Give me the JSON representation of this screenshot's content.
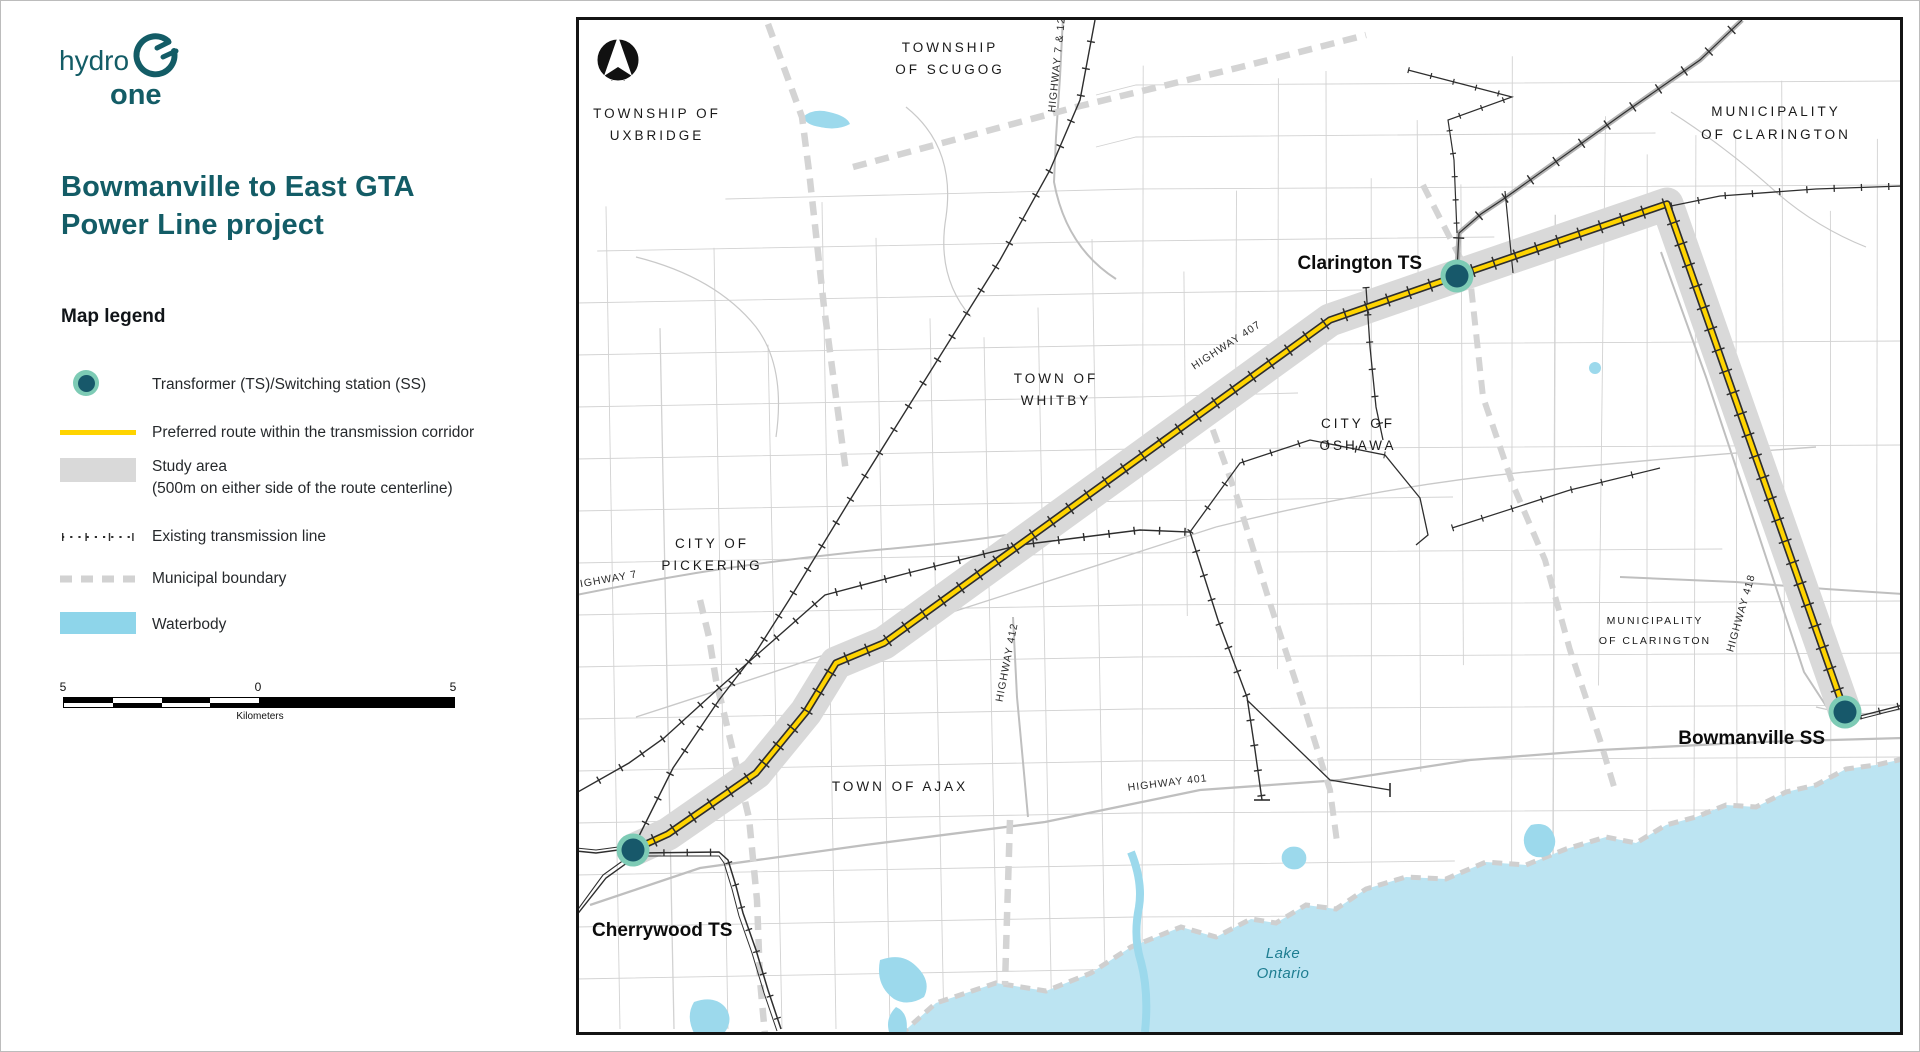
{
  "branding": {
    "logo_text_top": "hydro",
    "logo_text_bottom": "one"
  },
  "panel": {
    "title_line1": "Bowmanville to East GTA",
    "title_line2": "Power Line project",
    "legend_heading": "Map legend",
    "legend": {
      "station": "Transformer (TS)/Switching station (SS)",
      "route": "Preferred route within the transmission corridor",
      "study_area_line1": "Study area",
      "study_area_line2": "(500m on either side of the route centerline)",
      "existing_line": "Existing transmission line",
      "municipal_boundary": "Municipal boundary",
      "waterbody": "Waterbody"
    },
    "scale_bar": {
      "left": "5",
      "middle": "0",
      "right": "5",
      "unit": "Kilometers"
    }
  },
  "map": {
    "stations": {
      "cherrywood": "Cherrywood TS",
      "clarington": "Clarington TS",
      "bowmanville": "Bowmanville SS"
    },
    "regions": {
      "uxbridge": [
        "TOWNSHIP OF",
        "UXBRIDGE"
      ],
      "scugog": [
        "TOWNSHIP",
        "OF SCUGOG"
      ],
      "clarington_north": [
        "MUNICIPALITY",
        "OF CLARINGTON"
      ],
      "whitby": [
        "TOWN OF",
        "WHITBY"
      ],
      "oshawa": [
        "CITY OF",
        "OSHAWA"
      ],
      "pickering": [
        "CITY OF",
        "PICKERING"
      ],
      "ajax": [
        "TOWN OF AJAX"
      ],
      "clarington_south": [
        "MUNICIPALITY",
        "OF CLARINGTON"
      ]
    },
    "highways": {
      "h7_12": "HIGHWAY 7 & 12",
      "h407": "HIGHWAY 407",
      "h412": "HIGHWAY 412",
      "h401": "HIGHWAY 401",
      "h418": "HIGHWAY 418",
      "h7": "HIGHWAY 7"
    },
    "water_label": [
      "Lake",
      "Ontario"
    ]
  },
  "colors": {
    "brand_teal": "#135c66",
    "route_yellow": "#ffd400",
    "study_gray": "#d9d9d9",
    "legend_water_blue": "#8ed5ea",
    "lake_blue": "#bce4f2",
    "marker_outer": "#7dcbb5",
    "marker_inner": "#17586a"
  }
}
